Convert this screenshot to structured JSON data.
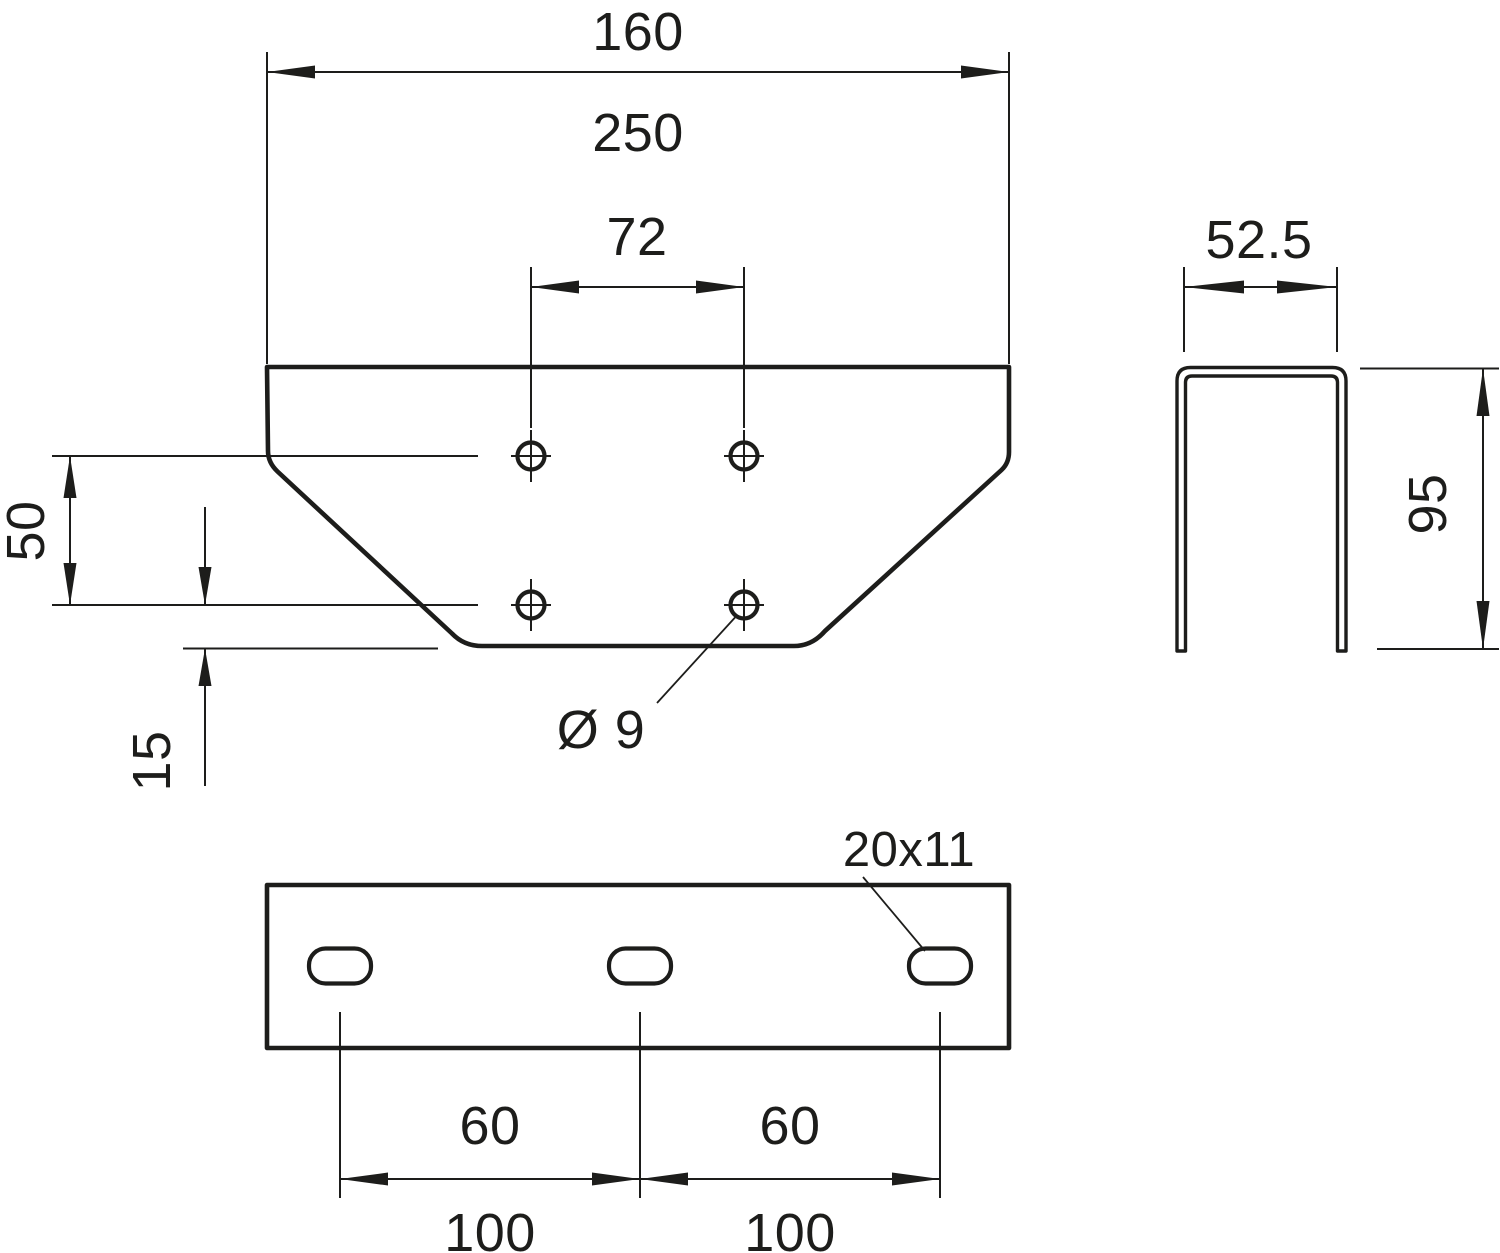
{
  "drawing": {
    "front_view": {
      "width_dim_primary": "160",
      "width_dim_secondary": "250",
      "hole_spacing_dim": "72",
      "hole_row_spacing_dim": "50",
      "bottom_offset_dim": "15",
      "hole_diameter_label": "Ø 9"
    },
    "side_view": {
      "width_dim": "52.5",
      "height_dim": "95"
    },
    "bottom_view": {
      "slot_size_label": "20x11",
      "slot_spacing_primary": [
        "60",
        "60"
      ],
      "slot_spacing_secondary": [
        "100",
        "100"
      ]
    },
    "colors": {
      "line": "#1d1d1b",
      "background": "#ffffff"
    }
  }
}
